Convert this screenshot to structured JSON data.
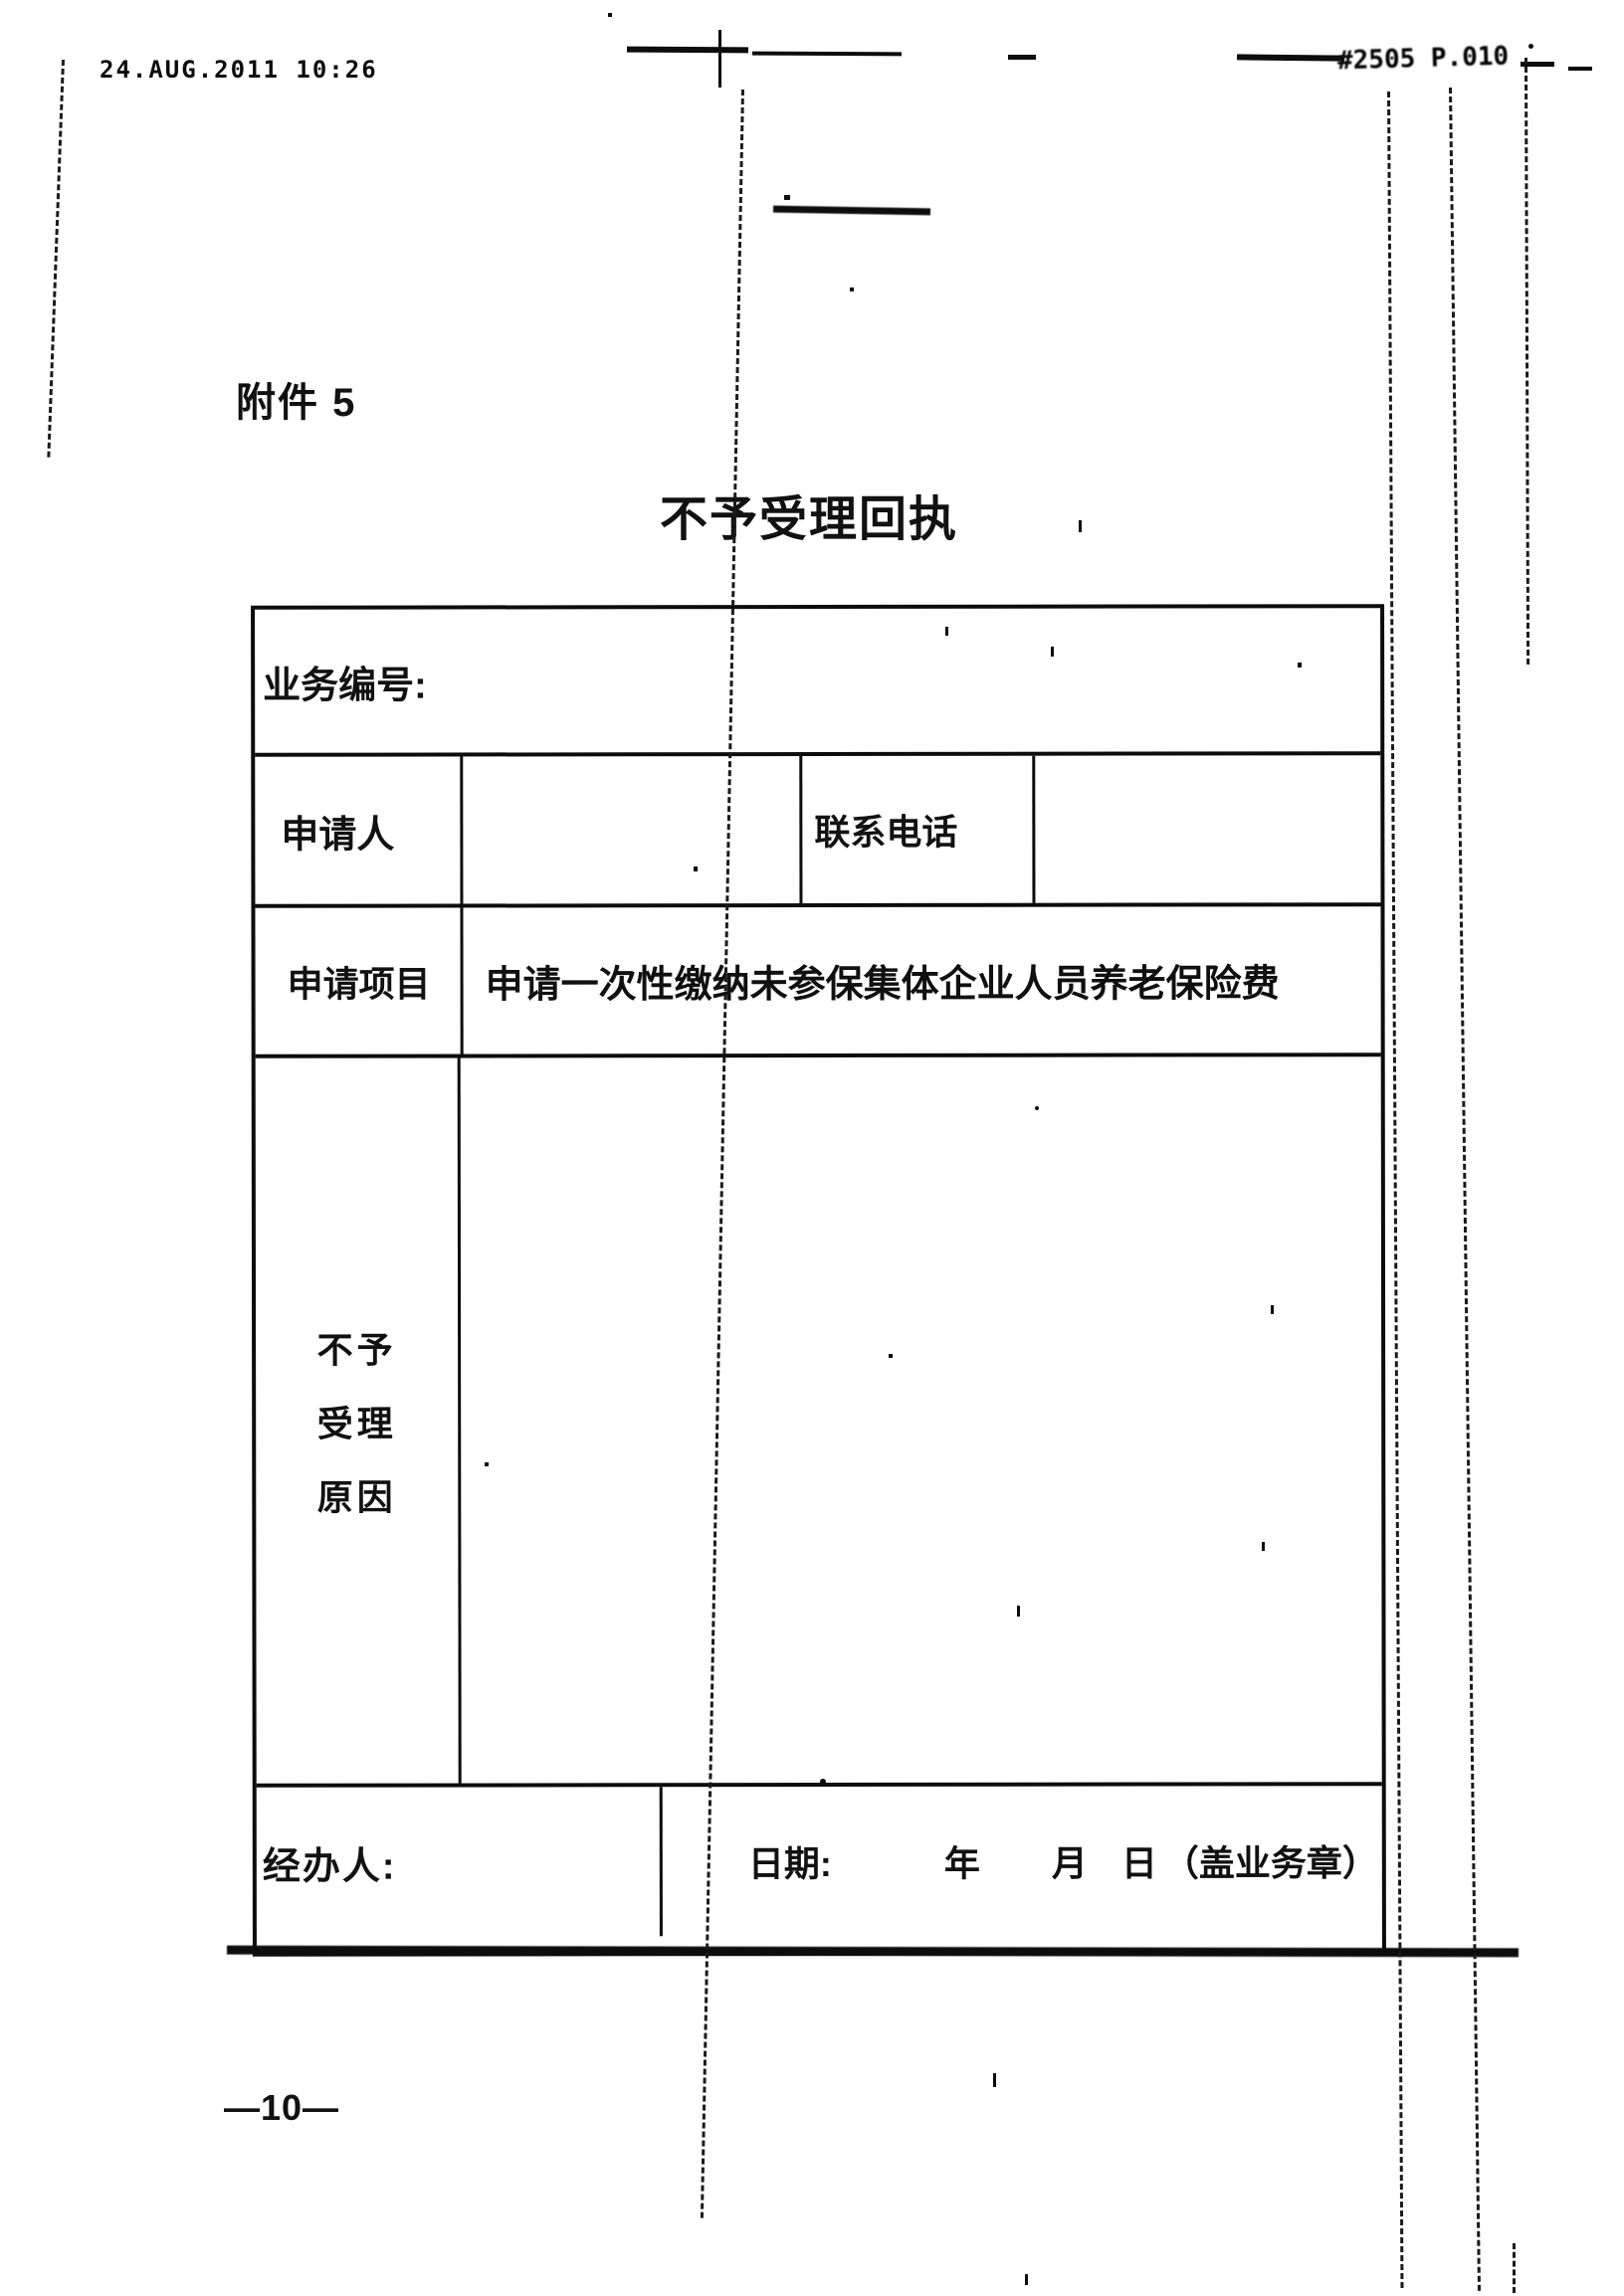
{
  "page": {
    "fax_timestamp": "24.AUG.2011 10:26",
    "fax_page_stamp": "#2505 P.010",
    "attachment_label": "附件 5",
    "title": "不予受理回执",
    "page_number": "—10—"
  },
  "form": {
    "business_no_label": "业务编号:",
    "business_no_value": "",
    "applicant_label": "申请人",
    "applicant_value": "",
    "phone_label": "联系电话",
    "phone_value": "",
    "item_label": "申请项目",
    "item_value": "申请一次性缴纳未参保集体企业人员养老保险费",
    "reason_label_line1": "不予",
    "reason_label_line2": "受理",
    "reason_label_line3": "原因",
    "reason_value": "",
    "handler_label": "经办人:",
    "date_label": "日期:",
    "year_label": "年",
    "month_label": "月",
    "day_label": "日",
    "seal_label": "（盖业务章）"
  },
  "colors": {
    "ink": "#111111",
    "paper": "#ffffff"
  }
}
